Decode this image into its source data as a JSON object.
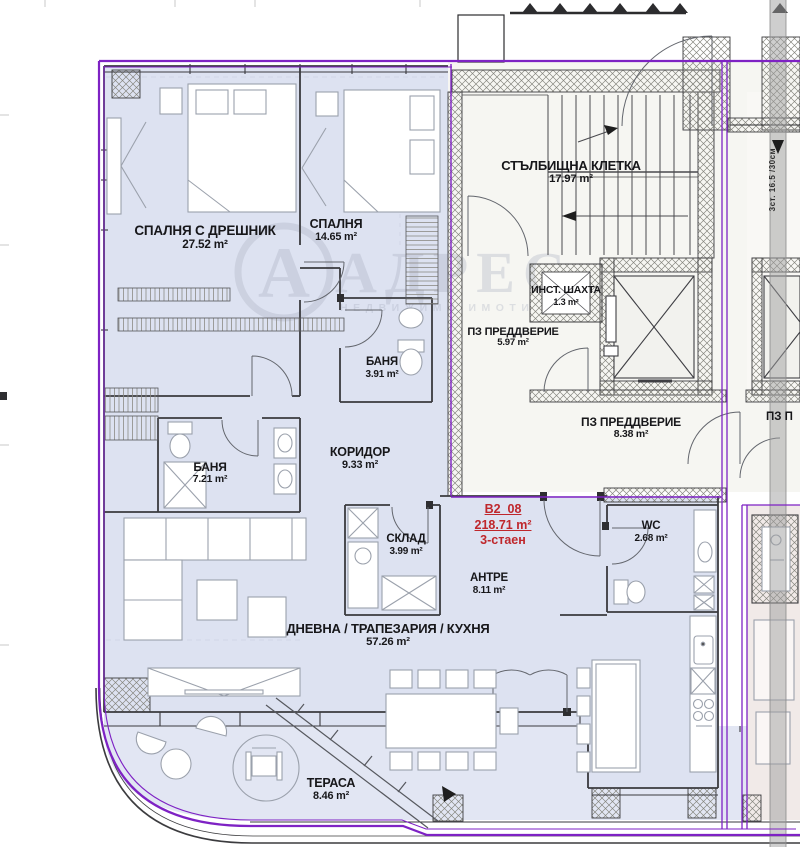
{
  "watermark": {
    "letter": "А",
    "brand": "АДРЕС",
    "tagline": "НЕДВИЖИМИ ИМОТИ"
  },
  "unit": {
    "id": "B2_08",
    "area": "218.71 m²",
    "type": "3-стаен"
  },
  "rooms": [
    {
      "name": "СПАЛНЯ С ДРЕШНИК",
      "area": "27.52 m²"
    },
    {
      "name": "СПАЛНЯ",
      "area": "14.65 m²"
    },
    {
      "name": "СТЪЛБИЩНА КЛЕТКА",
      "area": "17.97 m²"
    },
    {
      "name": "ИНСТ. ШАХТА",
      "area": "1.3 m²"
    },
    {
      "name": "ПЗ ПРЕДДВЕРИЕ",
      "area": "5.97 m²"
    },
    {
      "name": "ПЗ ПРЕДДВЕРИЕ",
      "area": "8.38 m²"
    },
    {
      "name": "БАНЯ",
      "area": "3.91 m²"
    },
    {
      "name": "БАНЯ",
      "area": "7.21 m²"
    },
    {
      "name": "КОРИДОР",
      "area": "9.33 m²"
    },
    {
      "name": "СКЛАД",
      "area": "3.99 m²"
    },
    {
      "name": "АНТРЕ",
      "area": "8.11 m²"
    },
    {
      "name": "WC",
      "area": "2.68 m²"
    },
    {
      "name": "ДНЕВНА / ТРАПЕЗАРИЯ / КУХНЯ",
      "area": "57.26 m²"
    },
    {
      "name": "ТЕРАСА",
      "area": "8.46 m²"
    }
  ],
  "annotations": {
    "stair_spec": "3ст. 16.5 /30см",
    "clipped_neighbor_room": "ПЗ П"
  },
  "colors": {
    "boundary_purple": "#7e22c4",
    "unit_red": "#bf272c",
    "floor_lavender": "#dde2f1",
    "neighbor_pink": "#f1eae8"
  }
}
